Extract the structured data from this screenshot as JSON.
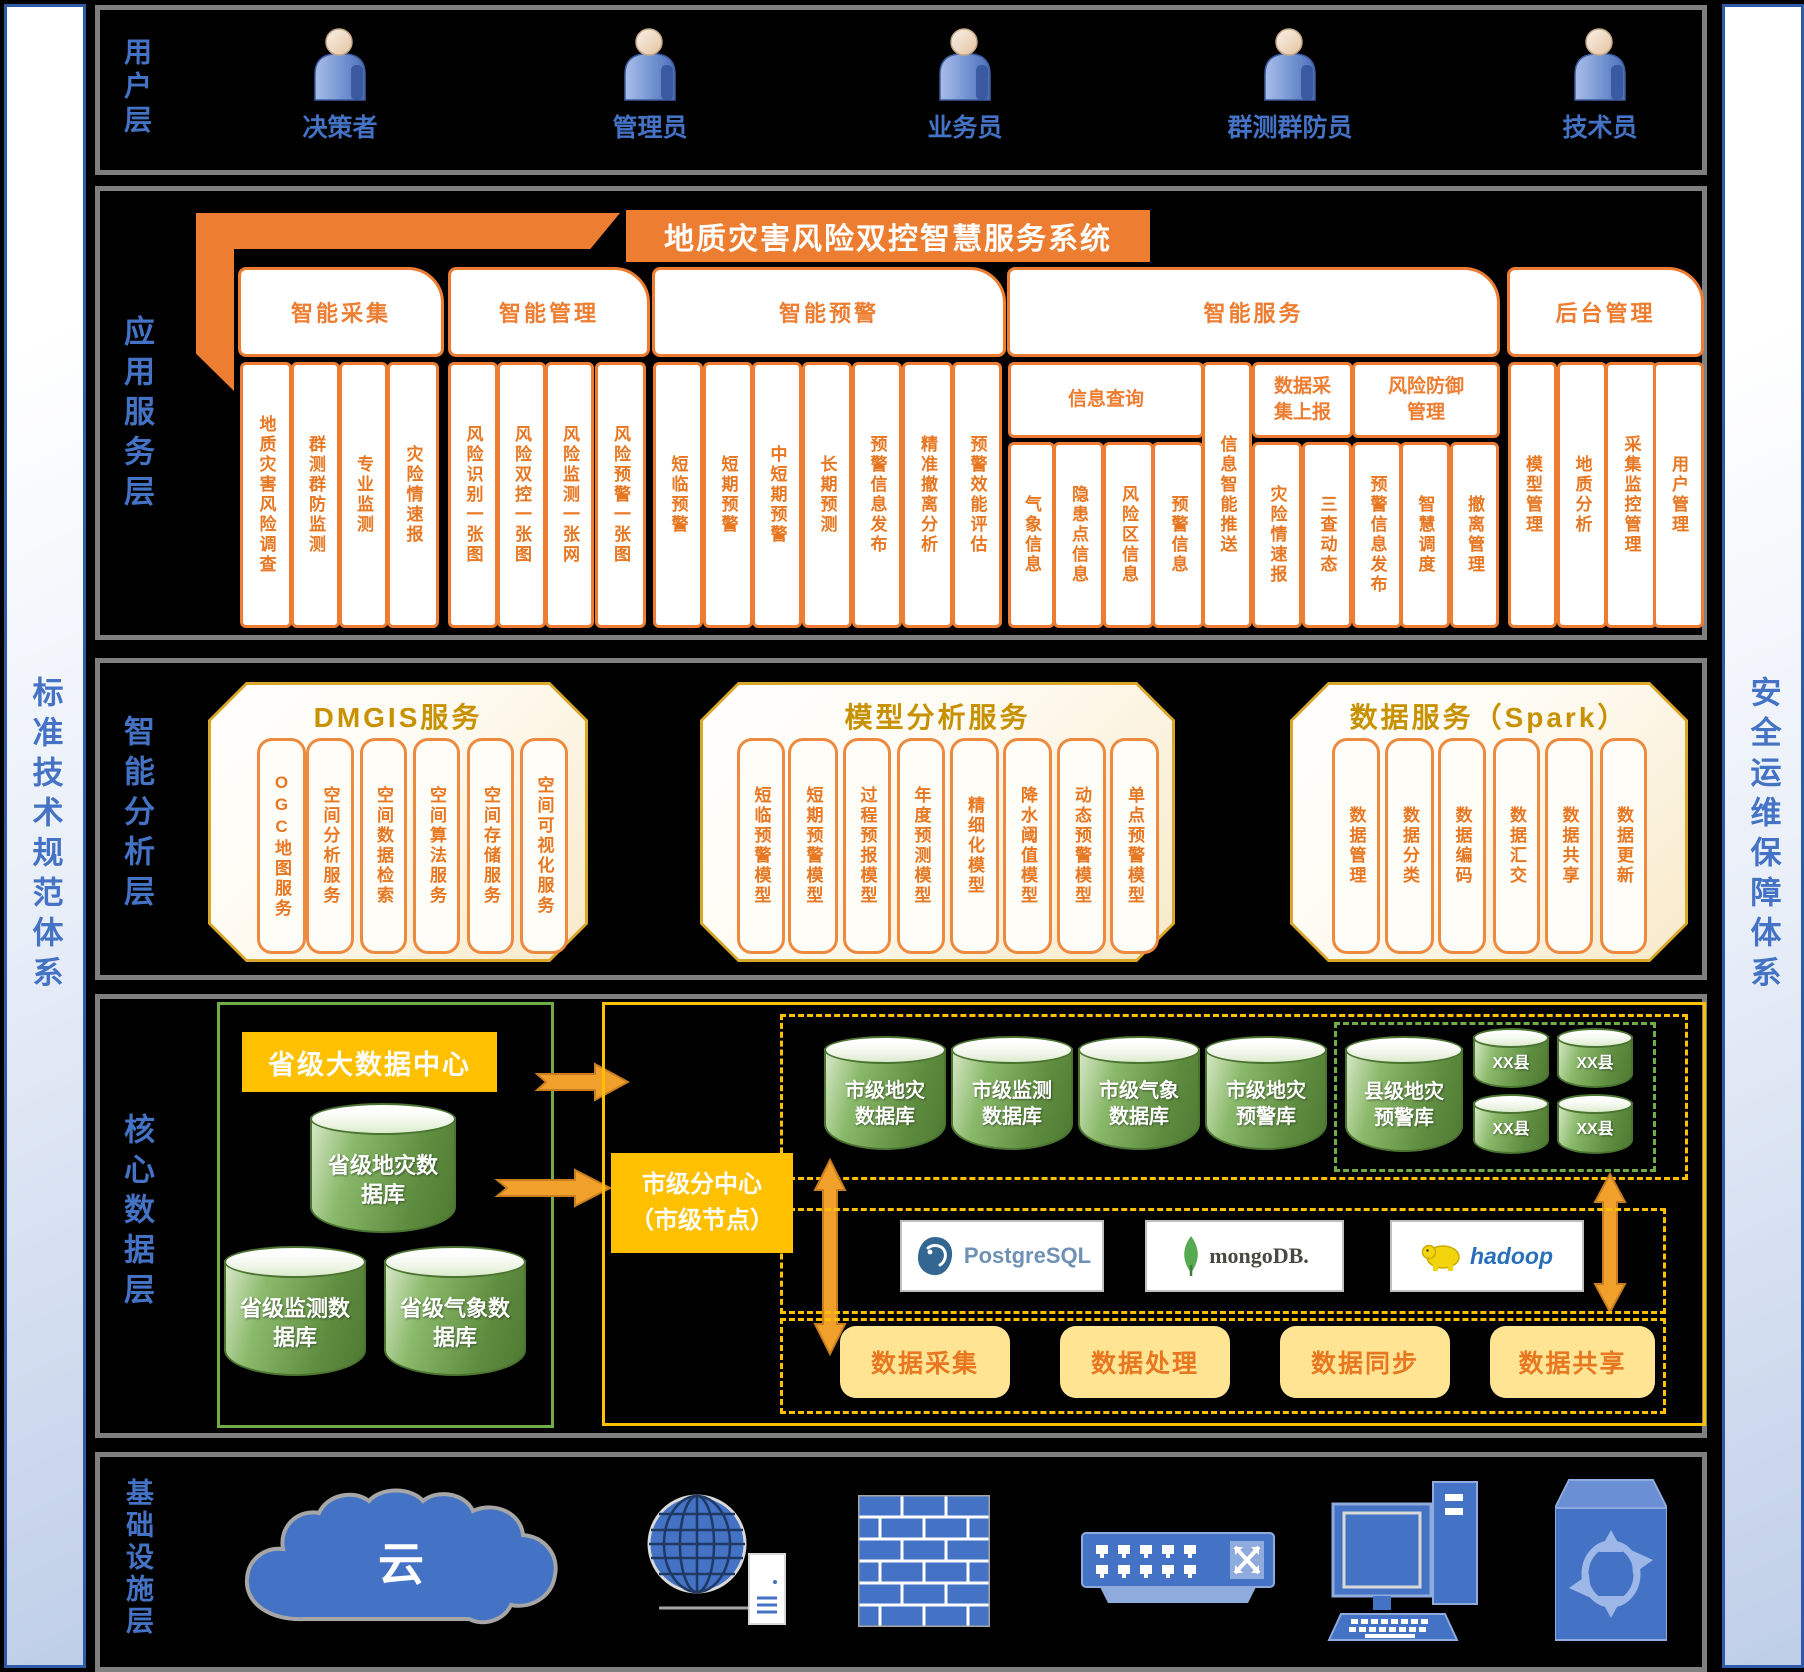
{
  "colors": {
    "orange": "#ED7D31",
    "gold": "#FFC000",
    "green": "#70AD47",
    "blue": "#4472C4"
  },
  "sidebars": {
    "left": "标准技术规范体系",
    "right": "安全运维保障体系"
  },
  "user_layer": {
    "label": "用户层",
    "users": [
      "决策者",
      "管理员",
      "业务员",
      "群测群防员",
      "技术员"
    ]
  },
  "app_layer": {
    "label": "应用服务层",
    "system_title": "地质灾害风险双控智慧服务系统",
    "groups": [
      {
        "title": "智能采集",
        "items": [
          "地质灾害风险调查",
          "群测群防监测",
          "专业监测",
          "灾险情速报"
        ]
      },
      {
        "title": "智能管理",
        "items": [
          "风险识别一张图",
          "风险双控一张图",
          "风险监测一张网",
          "风险预警一张图"
        ]
      },
      {
        "title": "智能预警",
        "items": [
          "短临预警",
          "短期预警",
          "中短期预警",
          "长期预测",
          "预警信息发布",
          "精准撤离分析",
          "预警效能评估"
        ]
      },
      {
        "title": "智能服务",
        "standalone": "信息智能推送",
        "subgroups": [
          {
            "title": "信息查询",
            "items": [
              "气象信息",
              "隐患点信息",
              "风险区信息",
              "预警信息"
            ]
          },
          {
            "title": "数据采集上报",
            "items": [
              "灾险情速报",
              "三查动态"
            ]
          },
          {
            "title": "风险防御管理",
            "items": [
              "预警信息发布",
              "智慧调度",
              "撤离管理"
            ]
          }
        ]
      },
      {
        "title": "后台管理",
        "items": [
          "模型管理",
          "地质分析",
          "采集监控管理",
          "用户管理"
        ]
      }
    ]
  },
  "analysis_layer": {
    "label": "智能分析层",
    "panels": [
      {
        "title": "DMGIS服务",
        "items": [
          "OGC地图服务",
          "空间分析服务",
          "空间数据检索",
          "空间算法服务",
          "空间存储服务",
          "空间可视化服务"
        ]
      },
      {
        "title": "模型分析服务",
        "items": [
          "短临预警模型",
          "短期预警模型",
          "过程预报模型",
          "年度预测模型",
          "精细化模型",
          "降水阈值模型",
          "动态预警模型",
          "单点预警模型"
        ]
      },
      {
        "title": "数据服务（Spark）",
        "items": [
          "数据管理",
          "数据分类",
          "数据编码",
          "数据汇交",
          "数据共享",
          "数据更新"
        ]
      }
    ]
  },
  "data_layer": {
    "label": "核心数据层",
    "province": {
      "title": "省级大数据中心",
      "databases": [
        "省级地灾数据库",
        "省级监测数据库",
        "省级气象数据库"
      ]
    },
    "city": {
      "title": "市级分中心",
      "subtitle": "（市级节点）",
      "databases": [
        "市级地灾数据库",
        "市级监测数据库",
        "市级气象数据库",
        "市级地灾预警库"
      ],
      "county": {
        "main": "县级地灾预警库",
        "nodes": [
          "XX县",
          "XX县",
          "XX县",
          "XX县"
        ]
      },
      "technologies": [
        "PostgreSQL",
        "mongoDB.",
        "hadoop"
      ],
      "processes": [
        "数据采集",
        "数据处理",
        "数据同步",
        "数据共享"
      ]
    }
  },
  "infra_layer": {
    "label": "基础设施层",
    "cloud_label": "云"
  }
}
